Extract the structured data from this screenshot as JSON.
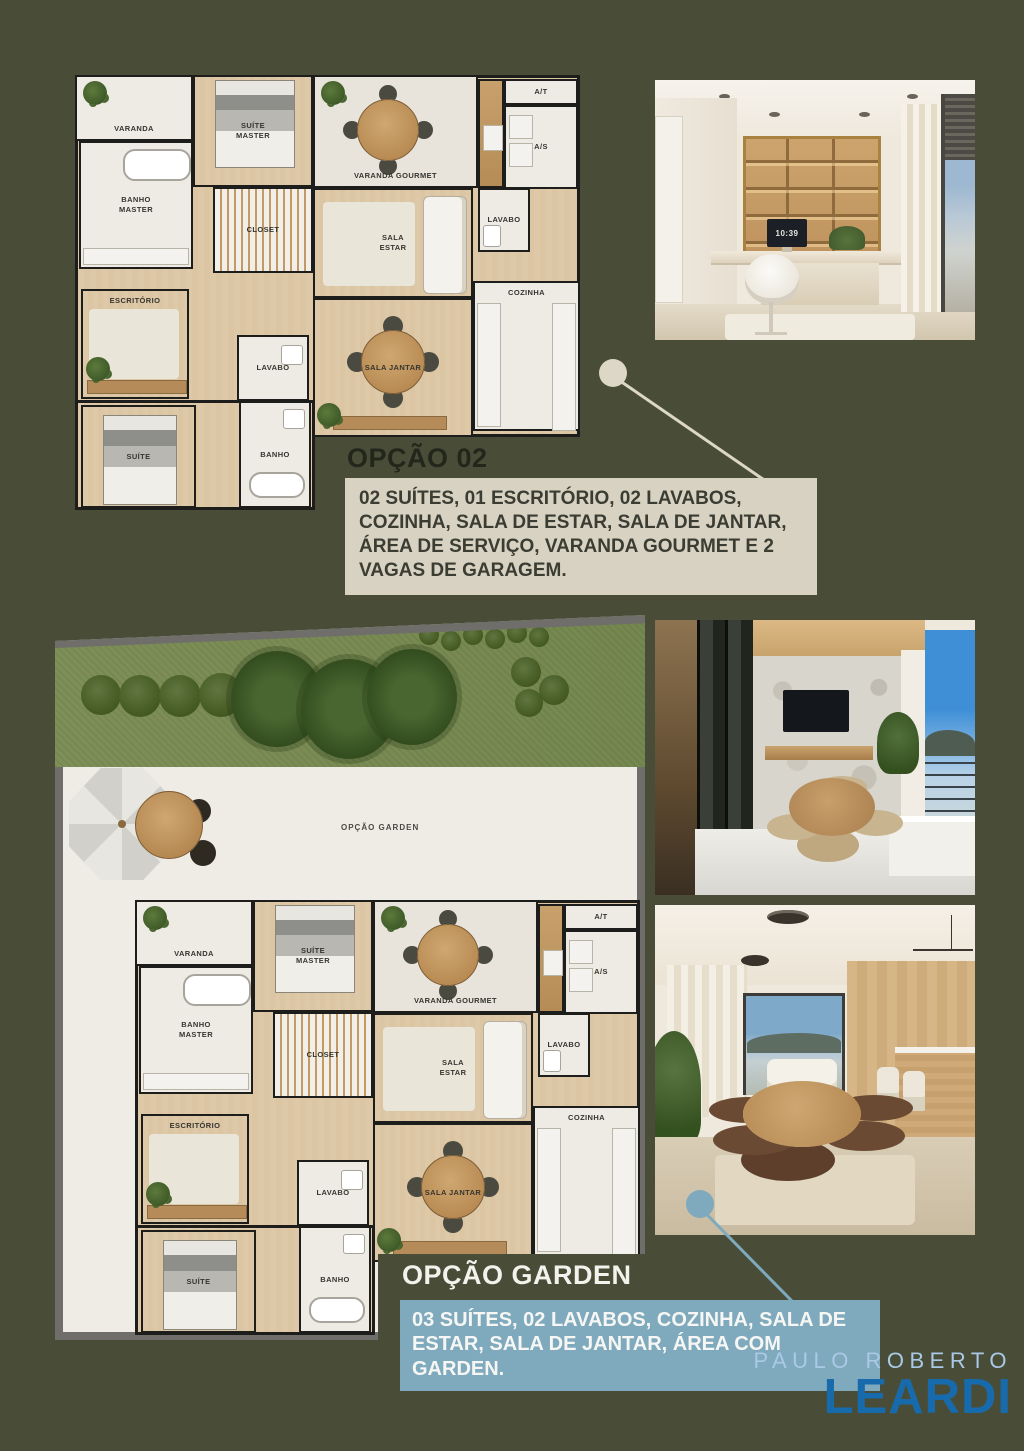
{
  "plan1": {
    "labels": {
      "varanda": "VARANDA",
      "suite_master": "SUÍTE MASTER",
      "banho_master": "BANHO MASTER",
      "closet": "CLOSET",
      "varanda_gourmet": "VARANDA GOURMET",
      "at": "A/T",
      "as": "A/S",
      "lavabo_top": "LAVABO",
      "sala_estar": "SALA ESTAR",
      "escritorio": "ESCRITÓRIO",
      "lavabo_mid": "LAVABO",
      "suite": "SUÍTE",
      "banho": "BANHO",
      "sala_jantar": "SALA JANTAR",
      "cozinha": "COZINHA"
    }
  },
  "garden": {
    "plan_label": "OPÇÃO GARDEN",
    "labels": {
      "varanda": "VARANDA",
      "suite_master": "SUÍTE MASTER",
      "banho_master": "BANHO MASTER",
      "closet": "CLOSET",
      "varanda_gourmet": "VARANDA GOURMET",
      "at": "A/T",
      "as": "A/S",
      "lavabo_top": "LAVABO",
      "sala_estar": "SALA ESTAR",
      "escritorio": "ESCRITÓRIO",
      "lavabo_mid": "LAVABO",
      "suite": "SUÍTE",
      "banho": "BANHO",
      "sala_jantar": "SALA JANTAR",
      "cozinha": "COZINHA"
    }
  },
  "option02": {
    "title": "OPÇÃO 02",
    "description": "02 SUÍTES, 01 ESCRITÓRIO, 02 LAVABOS, COZINHA, SALA DE ESTAR, SALA DE JANTAR, ÁREA DE SERVIÇO, VARANDA GOURMET E 2 VAGAS DE GARAGEM."
  },
  "option_garden": {
    "title": "OPÇÃO GARDEN",
    "description": "03 SUÍTES, 02 LAVABOS, COZINHA, SALA DE ESTAR, SALA DE JANTAR, ÁREA COM GARDEN."
  },
  "photos": {
    "office_clock": "10:39"
  },
  "logo": {
    "line1": "PAULO ROBERTO",
    "line2": "LEARDI"
  },
  "colors": {
    "background_olive": "#494d38",
    "accent_beige": "#d8d2c3",
    "accent_blue": "#7fa9bc",
    "logo_light_blue": "#a9c9e6",
    "logo_blue": "#176bad"
  }
}
